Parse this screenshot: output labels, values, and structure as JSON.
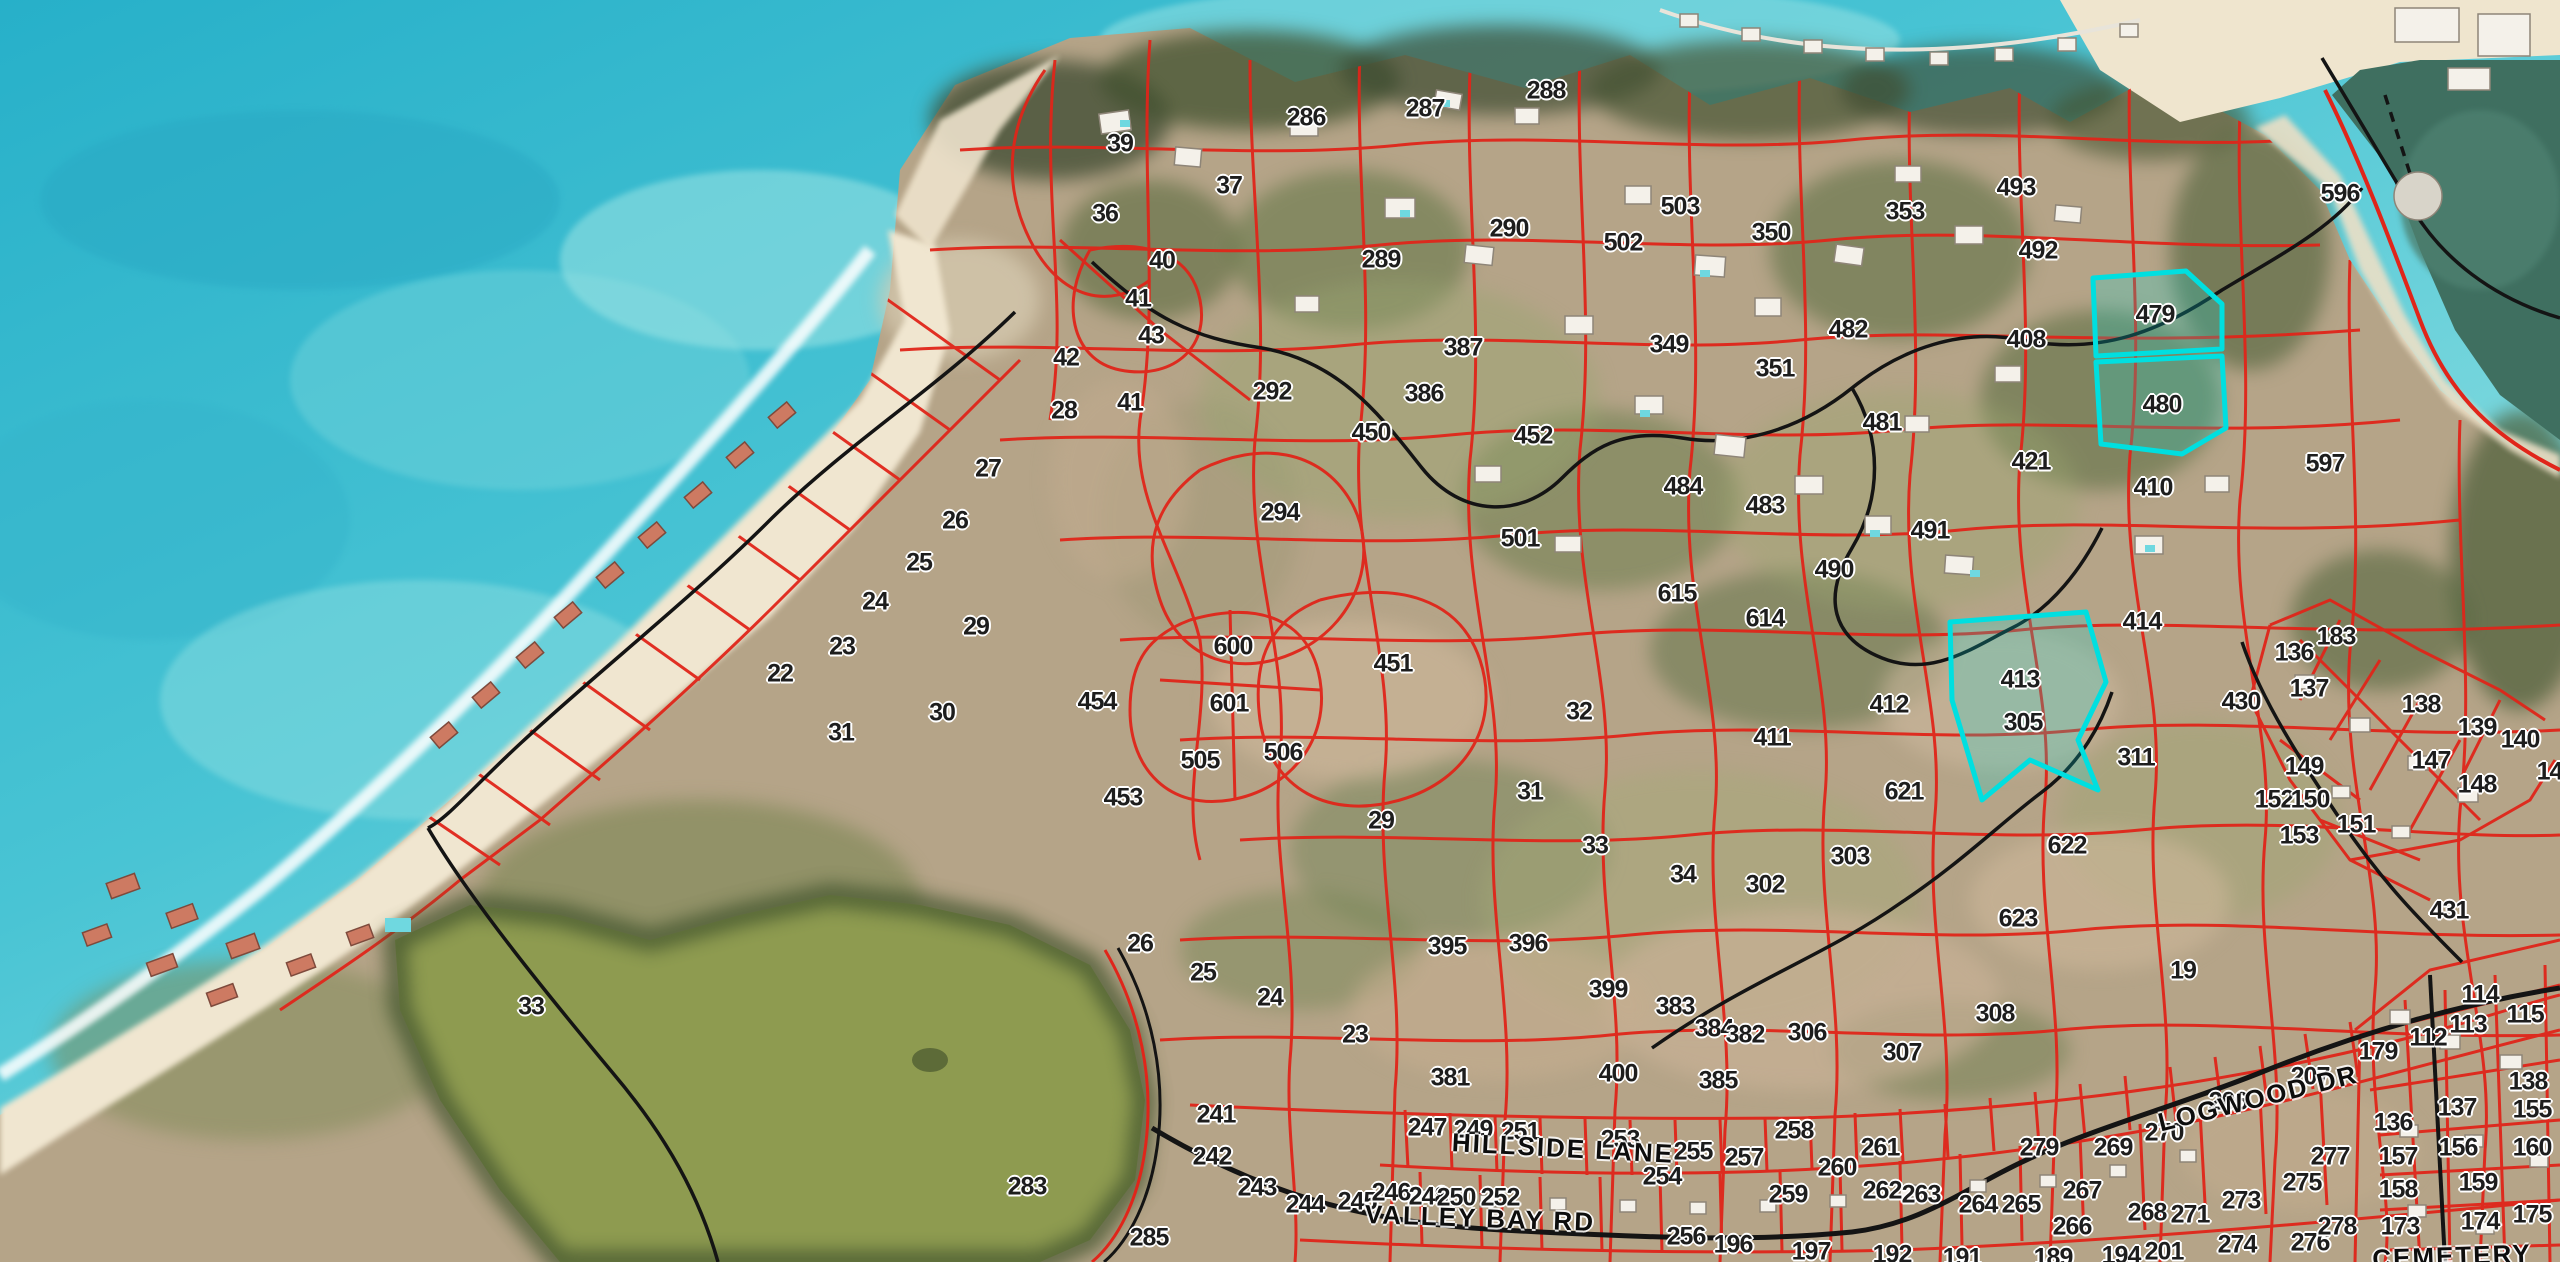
{
  "map": {
    "description": "Satellite imagery with cadastral parcel overlay",
    "boundary_color": "#e0251a",
    "highlight_color": "#00dfe0",
    "road_color": "#141414",
    "label_color": "#1d1d1d",
    "highlighted_parcels": [
      "479",
      "480",
      "413"
    ],
    "street_labels": [
      {
        "text": "HILLSIDE LANE",
        "x": 1563,
        "y": 1148,
        "rot": 3
      },
      {
        "text": "VALLEY BAY RD",
        "x": 1480,
        "y": 1218,
        "rot": 2
      },
      {
        "text": "LOGWOOD DR",
        "x": 2258,
        "y": 1098,
        "rot": -14
      },
      {
        "text": "CEMETERY",
        "x": 2452,
        "y": 1256,
        "rot": -2
      }
    ],
    "parcels": [
      {
        "n": "39",
        "x": 1120,
        "y": 144
      },
      {
        "n": "36",
        "x": 1105,
        "y": 214
      },
      {
        "n": "37",
        "x": 1229,
        "y": 186
      },
      {
        "n": "40",
        "x": 1162,
        "y": 261
      },
      {
        "n": "41",
        "x": 1138,
        "y": 299
      },
      {
        "n": "43",
        "x": 1151,
        "y": 336
      },
      {
        "n": "42",
        "x": 1066,
        "y": 358
      },
      {
        "n": "41",
        "x": 1130,
        "y": 403
      },
      {
        "n": "28",
        "x": 1064,
        "y": 411
      },
      {
        "n": "292",
        "x": 1272,
        "y": 392
      },
      {
        "n": "286",
        "x": 1306,
        "y": 118
      },
      {
        "n": "287",
        "x": 1425,
        "y": 109
      },
      {
        "n": "288",
        "x": 1546,
        "y": 91
      },
      {
        "n": "289",
        "x": 1381,
        "y": 260
      },
      {
        "n": "290",
        "x": 1509,
        "y": 229
      },
      {
        "n": "503",
        "x": 1680,
        "y": 207
      },
      {
        "n": "502",
        "x": 1623,
        "y": 243
      },
      {
        "n": "350",
        "x": 1771,
        "y": 233
      },
      {
        "n": "353",
        "x": 1905,
        "y": 212
      },
      {
        "n": "493",
        "x": 2016,
        "y": 188
      },
      {
        "n": "492",
        "x": 2038,
        "y": 251
      },
      {
        "n": "596",
        "x": 2340,
        "y": 194
      },
      {
        "n": "479",
        "x": 2155,
        "y": 315
      },
      {
        "n": "480",
        "x": 2162,
        "y": 405
      },
      {
        "n": "408",
        "x": 2026,
        "y": 340
      },
      {
        "n": "482",
        "x": 1848,
        "y": 330
      },
      {
        "n": "351",
        "x": 1775,
        "y": 369
      },
      {
        "n": "349",
        "x": 1669,
        "y": 345
      },
      {
        "n": "387",
        "x": 1463,
        "y": 348
      },
      {
        "n": "386",
        "x": 1424,
        "y": 394
      },
      {
        "n": "450",
        "x": 1371,
        "y": 433
      },
      {
        "n": "452",
        "x": 1533,
        "y": 436
      },
      {
        "n": "294",
        "x": 1280,
        "y": 513
      },
      {
        "n": "481",
        "x": 1882,
        "y": 423
      },
      {
        "n": "421",
        "x": 2031,
        "y": 462
      },
      {
        "n": "484",
        "x": 1683,
        "y": 487
      },
      {
        "n": "483",
        "x": 1765,
        "y": 506
      },
      {
        "n": "501",
        "x": 1520,
        "y": 539
      },
      {
        "n": "615",
        "x": 1677,
        "y": 594
      },
      {
        "n": "490",
        "x": 1834,
        "y": 570
      },
      {
        "n": "491",
        "x": 1930,
        "y": 531
      },
      {
        "n": "614",
        "x": 1765,
        "y": 619
      },
      {
        "n": "597",
        "x": 2325,
        "y": 464
      },
      {
        "n": "410",
        "x": 2153,
        "y": 488
      },
      {
        "n": "27",
        "x": 988,
        "y": 469
      },
      {
        "n": "26",
        "x": 955,
        "y": 521
      },
      {
        "n": "25",
        "x": 919,
        "y": 563
      },
      {
        "n": "24",
        "x": 875,
        "y": 602
      },
      {
        "n": "23",
        "x": 842,
        "y": 647
      },
      {
        "n": "22",
        "x": 780,
        "y": 674
      },
      {
        "n": "31",
        "x": 841,
        "y": 733
      },
      {
        "n": "29",
        "x": 976,
        "y": 627
      },
      {
        "n": "30",
        "x": 942,
        "y": 713
      },
      {
        "n": "454",
        "x": 1097,
        "y": 702
      },
      {
        "n": "600",
        "x": 1233,
        "y": 647
      },
      {
        "n": "601",
        "x": 1229,
        "y": 704
      },
      {
        "n": "505",
        "x": 1200,
        "y": 761
      },
      {
        "n": "506",
        "x": 1283,
        "y": 753
      },
      {
        "n": "453",
        "x": 1123,
        "y": 798
      },
      {
        "n": "29",
        "x": 1381,
        "y": 821
      },
      {
        "n": "451",
        "x": 1393,
        "y": 664
      },
      {
        "n": "32",
        "x": 1579,
        "y": 712
      },
      {
        "n": "31",
        "x": 1530,
        "y": 792
      },
      {
        "n": "33",
        "x": 1595,
        "y": 846
      },
      {
        "n": "34",
        "x": 1683,
        "y": 875
      },
      {
        "n": "302",
        "x": 1765,
        "y": 885
      },
      {
        "n": "303",
        "x": 1850,
        "y": 857
      },
      {
        "n": "621",
        "x": 1904,
        "y": 792
      },
      {
        "n": "622",
        "x": 2067,
        "y": 846
      },
      {
        "n": "623",
        "x": 2018,
        "y": 919
      },
      {
        "n": "308",
        "x": 1995,
        "y": 1014
      },
      {
        "n": "19",
        "x": 2183,
        "y": 971
      },
      {
        "n": "307",
        "x": 1902,
        "y": 1053
      },
      {
        "n": "306",
        "x": 1807,
        "y": 1033
      },
      {
        "n": "411",
        "x": 1772,
        "y": 738
      },
      {
        "n": "412",
        "x": 1889,
        "y": 705
      },
      {
        "n": "413",
        "x": 2020,
        "y": 680
      },
      {
        "n": "414",
        "x": 2142,
        "y": 622
      },
      {
        "n": "430",
        "x": 2241,
        "y": 702
      },
      {
        "n": "305",
        "x": 2023,
        "y": 723
      },
      {
        "n": "311",
        "x": 2136,
        "y": 758
      },
      {
        "n": "136",
        "x": 2294,
        "y": 653
      },
      {
        "n": "183",
        "x": 2336,
        "y": 637
      },
      {
        "n": "137",
        "x": 2309,
        "y": 689
      },
      {
        "n": "138",
        "x": 2421,
        "y": 705
      },
      {
        "n": "139",
        "x": 2477,
        "y": 728
      },
      {
        "n": "140",
        "x": 2520,
        "y": 740
      },
      {
        "n": "141",
        "x": 2556,
        "y": 772
      },
      {
        "n": "149",
        "x": 2304,
        "y": 767
      },
      {
        "n": "152",
        "x": 2274,
        "y": 800
      },
      {
        "n": "150",
        "x": 2310,
        "y": 800
      },
      {
        "n": "147",
        "x": 2431,
        "y": 761
      },
      {
        "n": "148",
        "x": 2477,
        "y": 785
      },
      {
        "n": "151",
        "x": 2356,
        "y": 825
      },
      {
        "n": "153",
        "x": 2299,
        "y": 836
      },
      {
        "n": "431",
        "x": 2449,
        "y": 911
      },
      {
        "n": "33",
        "x": 531,
        "y": 1007
      },
      {
        "n": "26",
        "x": 1140,
        "y": 944
      },
      {
        "n": "25",
        "x": 1203,
        "y": 973
      },
      {
        "n": "24",
        "x": 1270,
        "y": 998
      },
      {
        "n": "23",
        "x": 1355,
        "y": 1035
      },
      {
        "n": "395",
        "x": 1447,
        "y": 947
      },
      {
        "n": "396",
        "x": 1528,
        "y": 944
      },
      {
        "n": "399",
        "x": 1608,
        "y": 990
      },
      {
        "n": "383",
        "x": 1675,
        "y": 1007
      },
      {
        "n": "384",
        "x": 1714,
        "y": 1029
      },
      {
        "n": "382",
        "x": 1745,
        "y": 1035
      },
      {
        "n": "381",
        "x": 1450,
        "y": 1078
      },
      {
        "n": "400",
        "x": 1618,
        "y": 1074
      },
      {
        "n": "385",
        "x": 1718,
        "y": 1081
      },
      {
        "n": "283",
        "x": 1027,
        "y": 1187
      },
      {
        "n": "285",
        "x": 1149,
        "y": 1238
      },
      {
        "n": "241",
        "x": 1216,
        "y": 1115
      },
      {
        "n": "242",
        "x": 1212,
        "y": 1157
      },
      {
        "n": "243",
        "x": 1257,
        "y": 1188
      },
      {
        "n": "244",
        "x": 1305,
        "y": 1205
      },
      {
        "n": "245",
        "x": 1357,
        "y": 1202
      },
      {
        "n": "246",
        "x": 1391,
        "y": 1193
      },
      {
        "n": "247",
        "x": 1427,
        "y": 1128
      },
      {
        "n": "248",
        "x": 1428,
        "y": 1197
      },
      {
        "n": "249",
        "x": 1473,
        "y": 1130
      },
      {
        "n": "250",
        "x": 1456,
        "y": 1198
      },
      {
        "n": "251",
        "x": 1520,
        "y": 1132
      },
      {
        "n": "252",
        "x": 1500,
        "y": 1198
      },
      {
        "n": "253",
        "x": 1620,
        "y": 1140
      },
      {
        "n": "254",
        "x": 1662,
        "y": 1177
      },
      {
        "n": "255",
        "x": 1693,
        "y": 1152
      },
      {
        "n": "256",
        "x": 1686,
        "y": 1237
      },
      {
        "n": "257",
        "x": 1744,
        "y": 1158
      },
      {
        "n": "196",
        "x": 1733,
        "y": 1245
      },
      {
        "n": "258",
        "x": 1794,
        "y": 1131
      },
      {
        "n": "259",
        "x": 1788,
        "y": 1195
      },
      {
        "n": "260",
        "x": 1837,
        "y": 1168
      },
      {
        "n": "261",
        "x": 1880,
        "y": 1148
      },
      {
        "n": "262",
        "x": 1882,
        "y": 1191
      },
      {
        "n": "263",
        "x": 1921,
        "y": 1195
      },
      {
        "n": "264",
        "x": 1978,
        "y": 1205
      },
      {
        "n": "265",
        "x": 2021,
        "y": 1205
      },
      {
        "n": "266",
        "x": 2072,
        "y": 1227
      },
      {
        "n": "267",
        "x": 2082,
        "y": 1191
      },
      {
        "n": "268",
        "x": 2147,
        "y": 1213
      },
      {
        "n": "269",
        "x": 2113,
        "y": 1148
      },
      {
        "n": "270",
        "x": 2164,
        "y": 1133
      },
      {
        "n": "271",
        "x": 2190,
        "y": 1215
      },
      {
        "n": "273",
        "x": 2241,
        "y": 1201
      },
      {
        "n": "274",
        "x": 2237,
        "y": 1245
      },
      {
        "n": "275",
        "x": 2302,
        "y": 1183
      },
      {
        "n": "276",
        "x": 2310,
        "y": 1243
      },
      {
        "n": "277",
        "x": 2330,
        "y": 1157
      },
      {
        "n": "278",
        "x": 2337,
        "y": 1227
      },
      {
        "n": "279",
        "x": 2039,
        "y": 1148
      },
      {
        "n": "197",
        "x": 1811,
        "y": 1252
      },
      {
        "n": "192",
        "x": 1892,
        "y": 1255
      },
      {
        "n": "191",
        "x": 1962,
        "y": 1258
      },
      {
        "n": "189",
        "x": 2053,
        "y": 1258
      },
      {
        "n": "194",
        "x": 2121,
        "y": 1256
      },
      {
        "n": "201",
        "x": 2164,
        "y": 1252
      },
      {
        "n": "206",
        "x": 2228,
        "y": 1102
      },
      {
        "n": "207",
        "x": 2310,
        "y": 1077
      },
      {
        "n": "114",
        "x": 2480,
        "y": 995
      },
      {
        "n": "113",
        "x": 2468,
        "y": 1025
      },
      {
        "n": "115",
        "x": 2525,
        "y": 1015
      },
      {
        "n": "112",
        "x": 2428,
        "y": 1038
      },
      {
        "n": "179",
        "x": 2378,
        "y": 1052
      },
      {
        "n": "136",
        "x": 2393,
        "y": 1123
      },
      {
        "n": "137",
        "x": 2457,
        "y": 1108
      },
      {
        "n": "138",
        "x": 2528,
        "y": 1082
      },
      {
        "n": "155",
        "x": 2532,
        "y": 1110
      },
      {
        "n": "156",
        "x": 2458,
        "y": 1148
      },
      {
        "n": "157",
        "x": 2398,
        "y": 1157
      },
      {
        "n": "160",
        "x": 2532,
        "y": 1148
      },
      {
        "n": "158",
        "x": 2398,
        "y": 1190
      },
      {
        "n": "159",
        "x": 2478,
        "y": 1183
      },
      {
        "n": "173",
        "x": 2400,
        "y": 1227
      },
      {
        "n": "174",
        "x": 2480,
        "y": 1222
      },
      {
        "n": "175",
        "x": 2532,
        "y": 1215
      }
    ]
  }
}
